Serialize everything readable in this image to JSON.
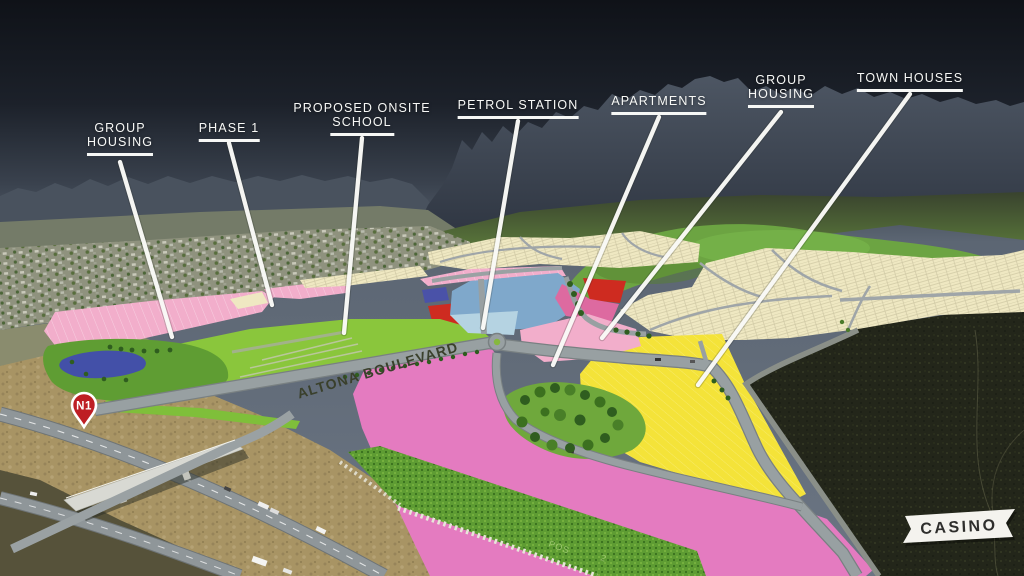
{
  "callouts": [
    {
      "id": "group-housing-west",
      "lines": [
        "GROUP",
        "HOUSING"
      ]
    },
    {
      "id": "phase-1",
      "lines": [
        "PHASE 1"
      ]
    },
    {
      "id": "proposed-onsite-school",
      "lines": [
        "PROPOSED ONSITE",
        "SCHOOL"
      ]
    },
    {
      "id": "petrol-station",
      "lines": [
        "PETROL STATION"
      ]
    },
    {
      "id": "apartments",
      "lines": [
        "APARTMENTS"
      ]
    },
    {
      "id": "group-housing-east",
      "lines": [
        "GROUP",
        "HOUSING"
      ]
    },
    {
      "id": "town-houses",
      "lines": [
        "TOWN HOUSES"
      ]
    }
  ],
  "road_label": "ALTONA BOULEVARD",
  "route_marker": "N1",
  "casino_label": "CASINO",
  "band_labels": [
    "POS",
    "2"
  ],
  "colors": {
    "sky_top": "#0F1218",
    "sky_horizon": "#6B7583",
    "mountains": "#3A4150",
    "field_green": "#8AC63C",
    "parcel_pink_light": "#F2AECB",
    "parcel_pink_hot": "#E47BC0",
    "parcel_rose": "#DD6AA0",
    "parcel_red": "#CE2B20",
    "parcel_yellow": "#F4E339",
    "parcel_blue_steel": "#7FA8CB",
    "parcel_blue_pale": "#B5D3E2",
    "parcel_navy": "#4A52A8",
    "plots_cream": "#EFE8C2",
    "road_grey": "#98A0A2",
    "terrain_dark": "#23261A",
    "terrain_tan": "#A89464",
    "label_white": "#F7F8F6",
    "pin_red": "#BE1E24"
  }
}
